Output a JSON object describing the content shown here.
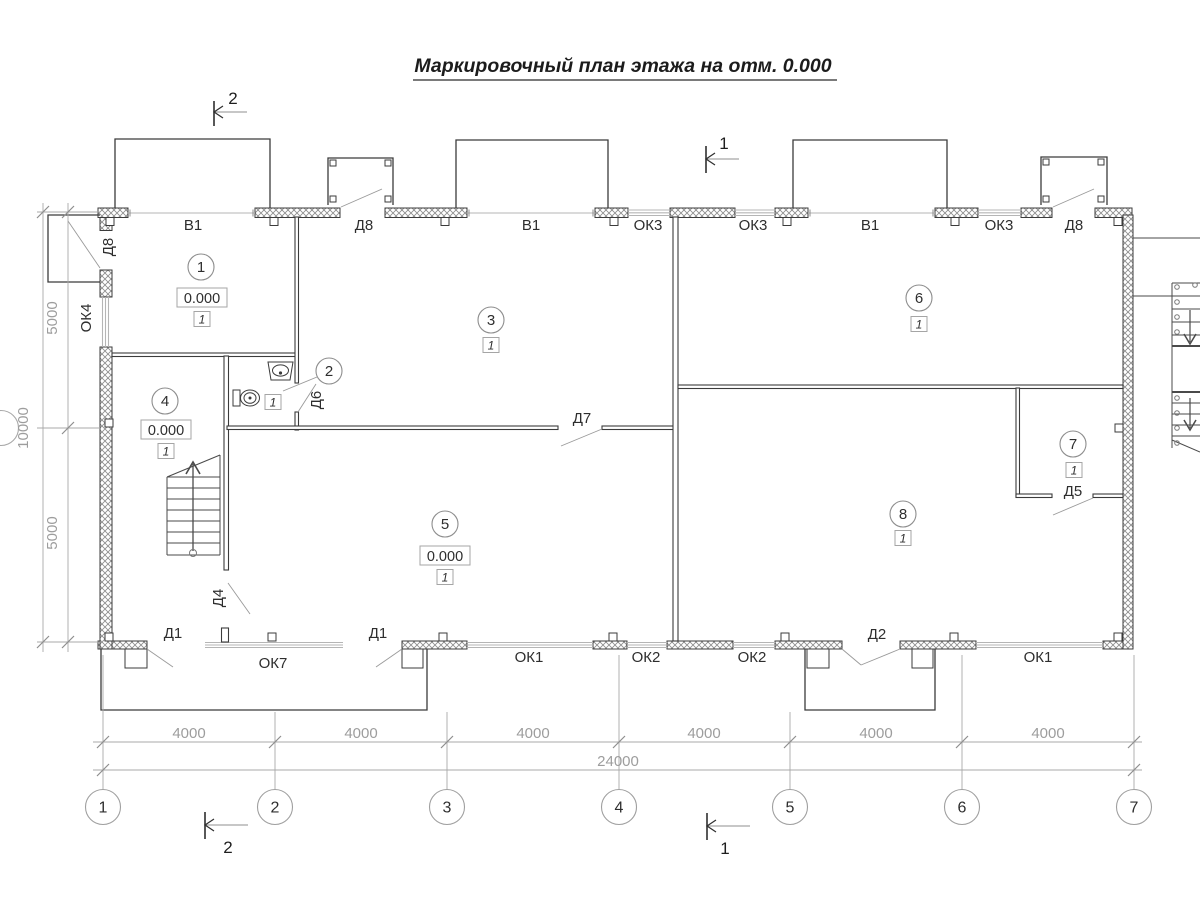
{
  "title": {
    "text": "Маркировочный план этажа на отм. 0.000"
  },
  "colors": {
    "wall_line": "#3b3b3b",
    "dim_gray": "#9f9f9f",
    "window_gray": "#b5b5b5",
    "text_dark": "#2a2a2a",
    "background": "#ffffff"
  },
  "opening_labels": [
    {
      "text": "В1",
      "x": 193,
      "y": 230
    },
    {
      "text": "Д8",
      "x": 364,
      "y": 230
    },
    {
      "text": "В1",
      "x": 531,
      "y": 230
    },
    {
      "text": "ОК3",
      "x": 648,
      "y": 230
    },
    {
      "text": "ОК3",
      "x": 753,
      "y": 230
    },
    {
      "text": "В1",
      "x": 870,
      "y": 230
    },
    {
      "text": "ОК3",
      "x": 999,
      "y": 230
    },
    {
      "text": "Д8",
      "x": 1074,
      "y": 230
    },
    {
      "text": "Д8",
      "x": 113,
      "y": 247,
      "rot": -90
    },
    {
      "text": "ОК4",
      "x": 91,
      "y": 318,
      "rot": -90
    },
    {
      "text": "Д6",
      "x": 321,
      "y": 400,
      "rot": -90
    },
    {
      "text": "Д7",
      "x": 582,
      "y": 423
    },
    {
      "text": "Д5",
      "x": 1073,
      "y": 496
    },
    {
      "text": "Д4",
      "x": 223,
      "y": 598,
      "rot": -90
    },
    {
      "text": "Д1",
      "x": 173,
      "y": 638
    },
    {
      "text": "ОК7",
      "x": 273,
      "y": 668
    },
    {
      "text": "Д1",
      "x": 378,
      "y": 638
    },
    {
      "text": "ОК1",
      "x": 529,
      "y": 662
    },
    {
      "text": "ОК2",
      "x": 646,
      "y": 662
    },
    {
      "text": "ОК2",
      "x": 752,
      "y": 662
    },
    {
      "text": "Д2",
      "x": 877,
      "y": 639
    },
    {
      "text": "ОК1",
      "x": 1038,
      "y": 662
    }
  ],
  "room_markers": [
    {
      "num": "1",
      "cx": 201,
      "cy": 267,
      "elev": "0.000",
      "elev_x": 202,
      "elev_y": 298,
      "type": "1",
      "type_x": 202,
      "type_y": 319
    },
    {
      "num": "2",
      "cx": 329,
      "cy": 371,
      "type": "1",
      "type_x": 273,
      "type_y": 402
    },
    {
      "num": "3",
      "cx": 491,
      "cy": 320,
      "type": "1",
      "type_x": 491,
      "type_y": 345
    },
    {
      "num": "4",
      "cx": 165,
      "cy": 401,
      "elev": "0.000",
      "elev_x": 166,
      "elev_y": 430,
      "type": "1",
      "type_x": 166,
      "type_y": 451
    },
    {
      "num": "5",
      "cx": 445,
      "cy": 524,
      "elev": "0.000",
      "elev_x": 445,
      "elev_y": 556,
      "type": "1",
      "type_x": 445,
      "type_y": 577
    },
    {
      "num": "6",
      "cx": 919,
      "cy": 298,
      "type": "1",
      "type_x": 919,
      "type_y": 324
    },
    {
      "num": "7",
      "cx": 1073,
      "cy": 444,
      "type": "1",
      "type_x": 1074,
      "type_y": 470
    },
    {
      "num": "8",
      "cx": 903,
      "cy": 514,
      "type": "1",
      "type_x": 903,
      "type_y": 538
    }
  ],
  "grid_axes": {
    "cy": 807,
    "r": 17.5,
    "circles": [
      {
        "label": "1",
        "x": 103
      },
      {
        "label": "2",
        "x": 275
      },
      {
        "label": "3",
        "x": 447
      },
      {
        "label": "4",
        "x": 619
      },
      {
        "label": "5",
        "x": 790
      },
      {
        "label": "6",
        "x": 962
      },
      {
        "label": "7",
        "x": 1134
      }
    ]
  },
  "dimensions": {
    "bottom_spans": [
      {
        "text": "4000",
        "x": 189
      },
      {
        "text": "4000",
        "x": 361
      },
      {
        "text": "4000",
        "x": 533
      },
      {
        "text": "4000",
        "x": 704
      },
      {
        "text": "4000",
        "x": 876
      },
      {
        "text": "4000",
        "x": 1048
      }
    ],
    "bottom_span_baseline": 738,
    "total": {
      "text": "24000",
      "x": 618,
      "y": 766
    },
    "left": [
      {
        "text": "5000",
        "x": 57,
        "y": 318
      },
      {
        "text": "10000",
        "x": 28,
        "y": 428
      },
      {
        "text": "5000",
        "x": 57,
        "y": 533
      }
    ]
  },
  "section_marks": [
    {
      "label": "2",
      "x": 233,
      "y": 104
    },
    {
      "label": "1",
      "x": 724,
      "y": 149
    },
    {
      "label": "2",
      "x": 228,
      "y": 853
    },
    {
      "label": "1",
      "x": 725,
      "y": 854
    }
  ]
}
